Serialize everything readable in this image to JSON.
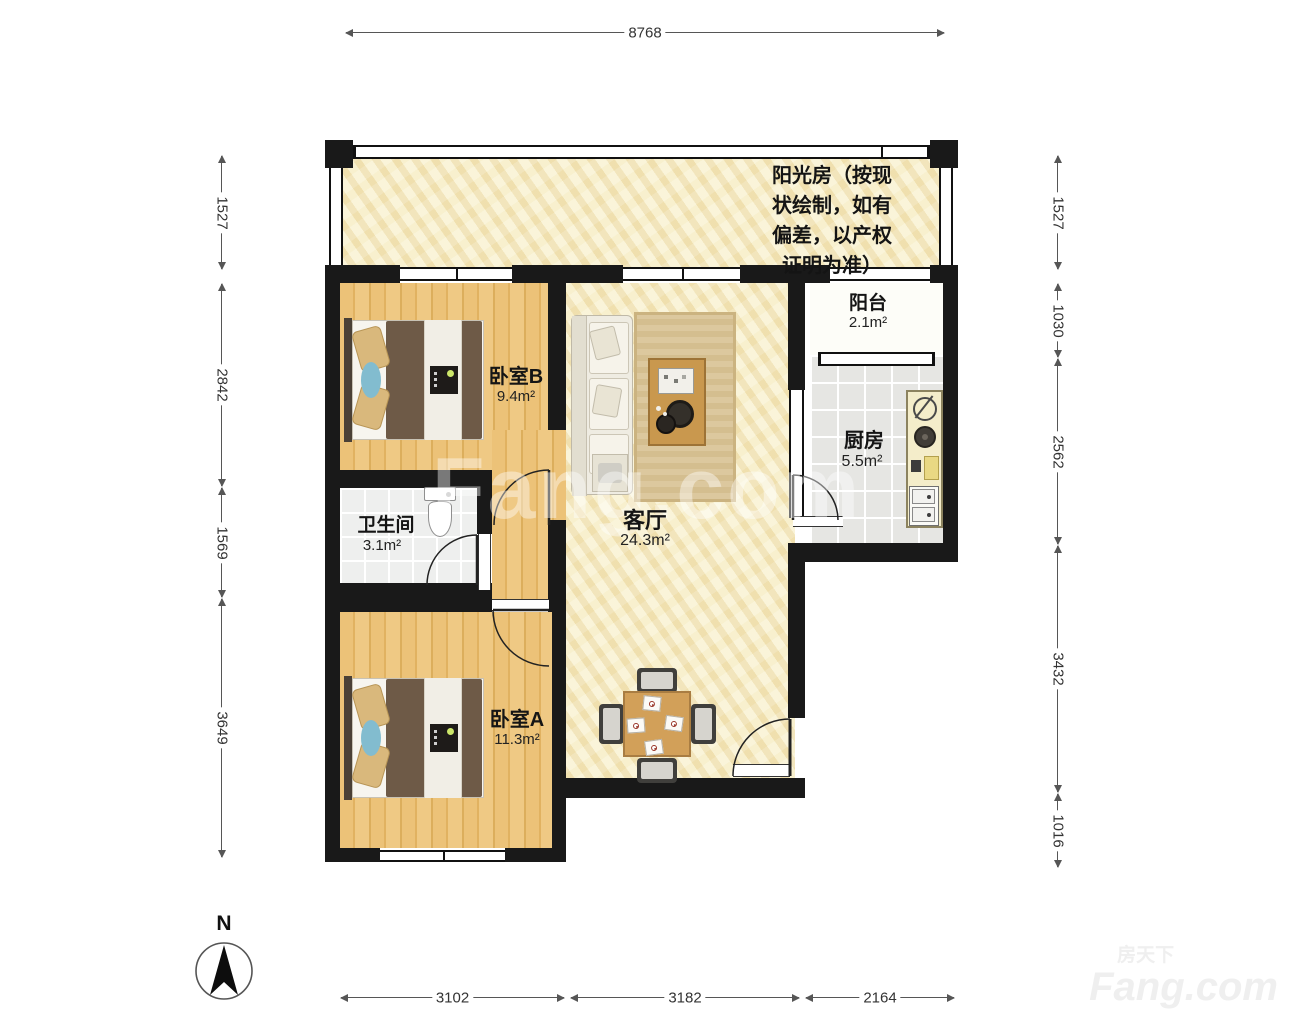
{
  "plan": {
    "sunroom": {
      "note": "阳光房（按现\n状绘制，如有\n偏差，以产权\n证明为准）"
    },
    "rooms": {
      "balcony": {
        "label": "阳台",
        "area": "2.1m²"
      },
      "kitchen": {
        "label": "厨房",
        "area": "5.5m²"
      },
      "bedroom_b": {
        "label": "卧室B",
        "area": "9.4m²"
      },
      "living": {
        "label": "客厅",
        "area": "24.3m²"
      },
      "bathroom": {
        "label": "卫生间",
        "area": "3.1m²"
      },
      "bedroom_a": {
        "label": "卧室A",
        "area": "11.3m²"
      }
    }
  },
  "dimensions": {
    "top": "8768",
    "left": [
      "1527",
      "2842",
      "1569",
      "3649"
    ],
    "right": [
      "1527",
      "1030",
      "2562",
      "3432",
      "1016"
    ],
    "bottom": [
      "3102",
      "3182",
      "2164"
    ]
  },
  "compass": {
    "label": "N"
  },
  "watermark": {
    "center": "Fang.com",
    "cn": "房天下",
    "en": "Fang.com"
  },
  "colors": {
    "wall": "#191919",
    "wood": "#ecc278",
    "marble": "#f6eec9",
    "dim_text": "#333333"
  }
}
